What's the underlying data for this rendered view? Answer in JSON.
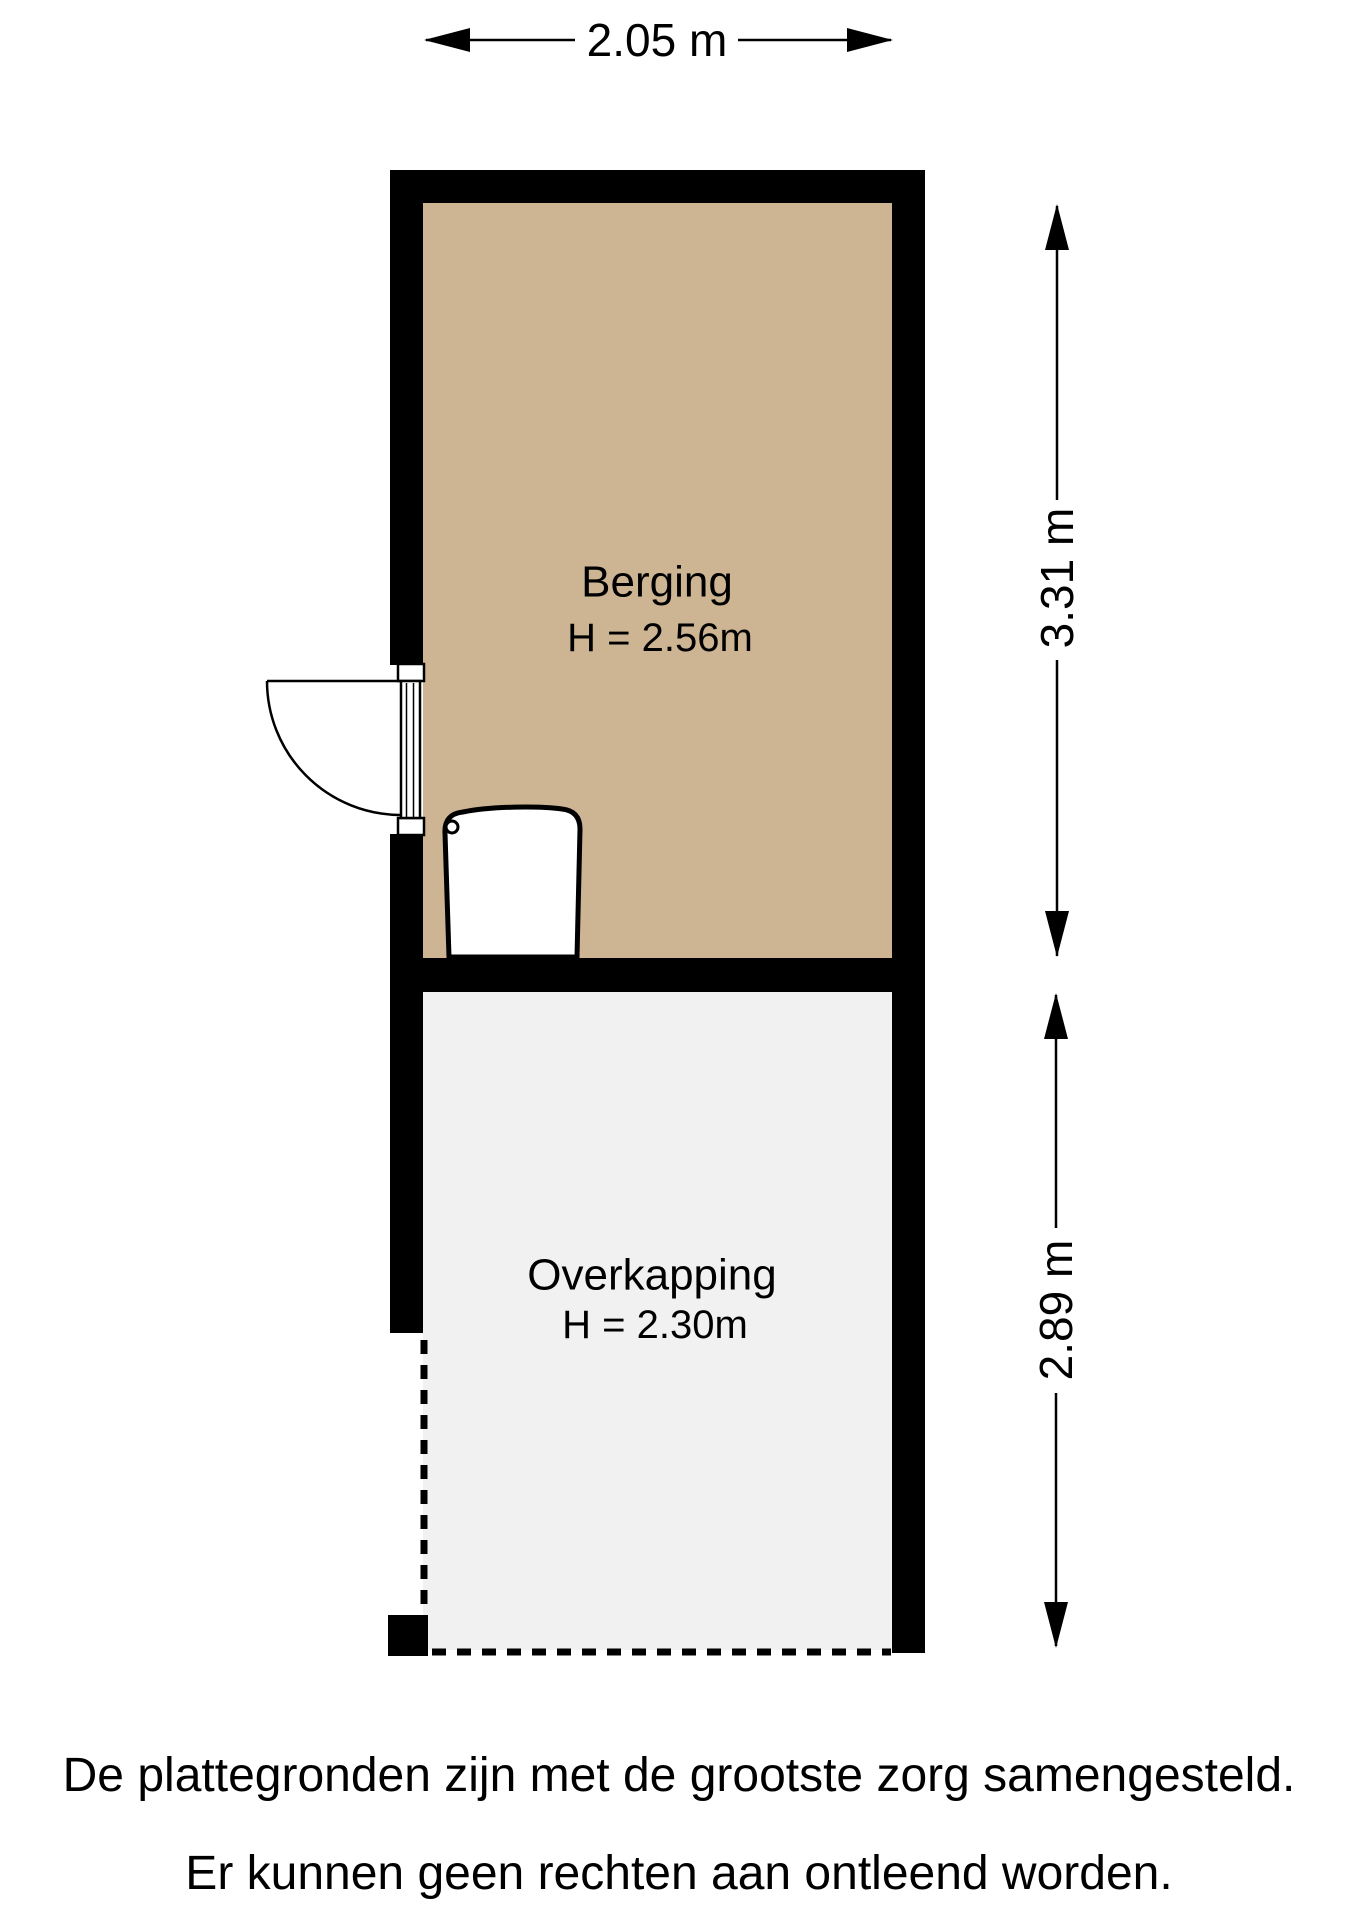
{
  "plan": {
    "rooms": [
      {
        "name": "Berging",
        "height_label": "H = 2.56m",
        "fill": "#CDB493"
      },
      {
        "name": "Overkapping",
        "height_label": "H = 2.30m",
        "fill": "#F1F1F1"
      }
    ],
    "dimensions": {
      "width_label": "2.05 m",
      "berging_depth_label": "3.31 m",
      "overkapping_depth_label": "2.89 m"
    },
    "wall_color": "#000000",
    "fixture_fill": "#FFFFFF"
  },
  "footer": {
    "line1": "De plattegronden zijn met de grootste zorg samengesteld.",
    "line2": "Er kunnen geen rechten aan ontleend worden."
  }
}
